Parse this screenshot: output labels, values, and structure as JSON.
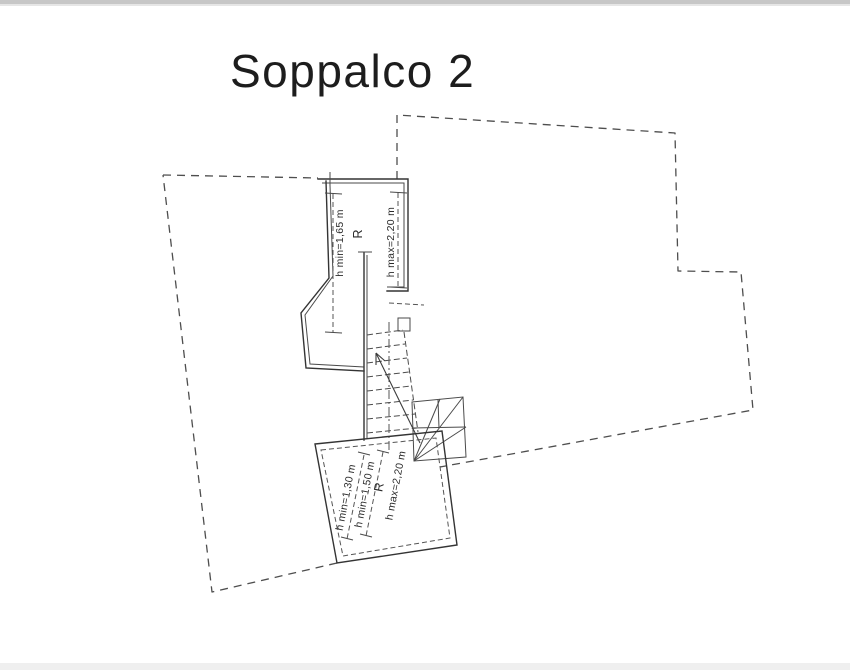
{
  "title": "Soppalco 2",
  "colors": {
    "line": "#343434",
    "paper": "#ffffff"
  },
  "upper_room": {
    "room_label": "R",
    "dim_min_height": "h min=1,65 m",
    "dim_max_height": "h max=2,20 m"
  },
  "lower_room": {
    "room_label": "R",
    "dim_min_height_1": "h min=1,30 m",
    "dim_min_height_2": "h min=1,50 m",
    "dim_max_height": "h max=2,20 m"
  }
}
